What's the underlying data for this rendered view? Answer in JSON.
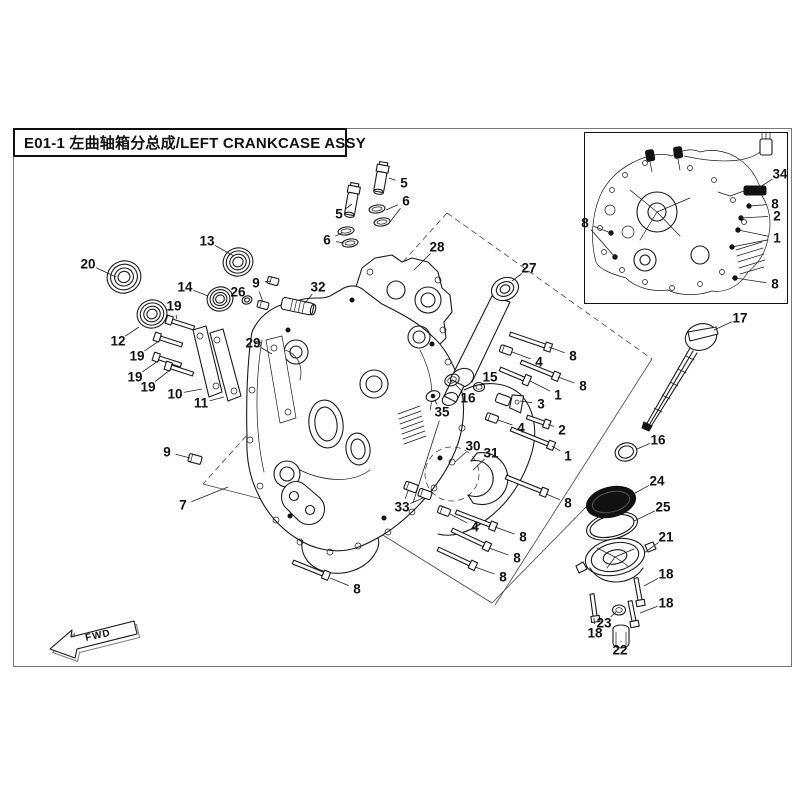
{
  "title": {
    "full": "E01-1  左曲轴箱分总成/LEFT CRANKCASE ASSY"
  },
  "fwd_label": "FWD",
  "colors": {
    "line": "#1a1a1a",
    "background": "#ffffff",
    "frame": "#777777"
  },
  "callouts": [
    {
      "n": "20",
      "x": 88,
      "y": 264,
      "t": [
        [
          116,
          277
        ]
      ]
    },
    {
      "n": "13",
      "x": 207,
      "y": 241,
      "t": [
        [
          234,
          256
        ]
      ]
    },
    {
      "n": "5",
      "x": 339,
      "y": 214,
      "t": [
        [
          352,
          204
        ]
      ]
    },
    {
      "n": "6",
      "x": 327,
      "y": 240,
      "t": [
        [
          342,
          233
        ],
        [
          344,
          243
        ]
      ]
    },
    {
      "n": "5",
      "x": 404,
      "y": 183,
      "t": [
        [
          389,
          178
        ]
      ]
    },
    {
      "n": "6",
      "x": 406,
      "y": 201,
      "t": [
        [
          386,
          210
        ],
        [
          390,
          222
        ]
      ]
    },
    {
      "n": "28",
      "x": 437,
      "y": 247,
      "t": [
        [
          414,
          270
        ]
      ]
    },
    {
      "n": "27",
      "x": 529,
      "y": 268,
      "t": [
        [
          512,
          281
        ]
      ]
    },
    {
      "n": "32",
      "x": 318,
      "y": 287,
      "t": [
        [
          305,
          303
        ]
      ]
    },
    {
      "n": "9",
      "x": 256,
      "y": 283,
      "t": [
        [
          271,
          281
        ],
        [
          263,
          302
        ]
      ]
    },
    {
      "n": "26",
      "x": 238,
      "y": 292,
      "t": [
        [
          246,
          299
        ]
      ]
    },
    {
      "n": "14",
      "x": 185,
      "y": 287,
      "t": [
        [
          208,
          296
        ]
      ]
    },
    {
      "n": "19",
      "x": 174,
      "y": 306,
      "t": [
        [
          177,
          319
        ]
      ]
    },
    {
      "n": "12",
      "x": 118,
      "y": 341,
      "t": [
        [
          139,
          327
        ]
      ]
    },
    {
      "n": "19",
      "x": 137,
      "y": 356,
      "t": [
        [
          159,
          341
        ]
      ]
    },
    {
      "n": "19",
      "x": 135,
      "y": 377,
      "t": [
        [
          158,
          361
        ]
      ]
    },
    {
      "n": "19",
      "x": 148,
      "y": 387,
      "t": [
        [
          170,
          370
        ]
      ]
    },
    {
      "n": "10",
      "x": 175,
      "y": 394,
      "t": [
        [
          202,
          389
        ]
      ]
    },
    {
      "n": "11",
      "x": 201,
      "y": 403,
      "t": [
        [
          224,
          397
        ]
      ]
    },
    {
      "n": "29",
      "x": 253,
      "y": 343,
      "t": [
        [
          272,
          354
        ]
      ]
    },
    {
      "n": "9",
      "x": 167,
      "y": 452,
      "t": [
        [
          190,
          458
        ]
      ]
    },
    {
      "n": "7",
      "x": 183,
      "y": 505,
      "t": [
        [
          228,
          487
        ]
      ]
    },
    {
      "n": "17",
      "x": 740,
      "y": 318,
      "t": [
        [
          714,
          330
        ]
      ]
    },
    {
      "n": "8",
      "x": 573,
      "y": 356,
      "t": [
        [
          549,
          347
        ]
      ]
    },
    {
      "n": "4",
      "x": 539,
      "y": 362,
      "t": [
        [
          512,
          352
        ]
      ]
    },
    {
      "n": "8",
      "x": 583,
      "y": 386,
      "t": [
        [
          558,
          377
        ]
      ]
    },
    {
      "n": "1",
      "x": 558,
      "y": 395,
      "t": [
        [
          530,
          381
        ]
      ]
    },
    {
      "n": "15",
      "x": 490,
      "y": 377,
      "t": [
        [
          481,
          386
        ]
      ]
    },
    {
      "n": "16",
      "x": 468,
      "y": 398,
      "t": [
        [
          455,
          384
        ]
      ]
    },
    {
      "n": "3",
      "x": 541,
      "y": 404,
      "t": [
        [
          520,
          401
        ]
      ]
    },
    {
      "n": "35",
      "x": 442,
      "y": 412,
      "t": [
        [
          435,
          401
        ],
        [
          413,
          503
        ]
      ]
    },
    {
      "n": "2",
      "x": 562,
      "y": 430,
      "t": [
        [
          548,
          424
        ]
      ]
    },
    {
      "n": "4",
      "x": 521,
      "y": 428,
      "t": [
        [
          498,
          420
        ]
      ]
    },
    {
      "n": "1",
      "x": 568,
      "y": 456,
      "t": [
        [
          552,
          446
        ]
      ]
    },
    {
      "n": "30",
      "x": 473,
      "y": 446,
      "t": [
        [
          455,
          462
        ]
      ]
    },
    {
      "n": "31",
      "x": 491,
      "y": 453,
      "t": [
        [
          473,
          470
        ]
      ]
    },
    {
      "n": "16",
      "x": 658,
      "y": 440,
      "t": [
        [
          637,
          449
        ]
      ]
    },
    {
      "n": "33",
      "x": 402,
      "y": 507,
      "t": [
        [
          408,
          491
        ],
        [
          423,
          498
        ]
      ]
    },
    {
      "n": "4",
      "x": 475,
      "y": 527,
      "t": [
        [
          450,
          514
        ]
      ]
    },
    {
      "n": "8",
      "x": 523,
      "y": 537,
      "t": [
        [
          495,
          527
        ]
      ]
    },
    {
      "n": "8",
      "x": 517,
      "y": 558,
      "t": [
        [
          489,
          548
        ]
      ]
    },
    {
      "n": "8",
      "x": 503,
      "y": 577,
      "t": [
        [
          475,
          567
        ]
      ]
    },
    {
      "n": "8",
      "x": 568,
      "y": 503,
      "t": [
        [
          546,
          494
        ]
      ]
    },
    {
      "n": "8",
      "x": 357,
      "y": 589,
      "t": [
        [
          330,
          578
        ]
      ]
    },
    {
      "n": "24",
      "x": 657,
      "y": 481,
      "t": [
        [
          628,
          497
        ]
      ]
    },
    {
      "n": "25",
      "x": 663,
      "y": 507,
      "t": [
        [
          634,
          521
        ]
      ]
    },
    {
      "n": "21",
      "x": 666,
      "y": 537,
      "t": [
        [
          644,
          553
        ]
      ]
    },
    {
      "n": "18",
      "x": 666,
      "y": 574,
      "t": [
        [
          644,
          586
        ]
      ]
    },
    {
      "n": "18",
      "x": 666,
      "y": 603,
      "t": [
        [
          640,
          613
        ]
      ]
    },
    {
      "n": "23",
      "x": 604,
      "y": 623,
      "t": [
        [
          616,
          612
        ]
      ]
    },
    {
      "n": "18",
      "x": 595,
      "y": 633,
      "t": [
        [
          594,
          618
        ]
      ]
    },
    {
      "n": "22",
      "x": 620,
      "y": 650,
      "t": [
        [
          621,
          642
        ]
      ]
    }
  ],
  "inset": {
    "callouts": [
      {
        "n": "34",
        "x": 780,
        "y": 174,
        "t": [
          [
            757,
            189
          ]
        ]
      },
      {
        "n": "8",
        "x": 775,
        "y": 204,
        "t": [
          [
            749,
            206
          ]
        ]
      },
      {
        "n": "2",
        "x": 777,
        "y": 216,
        "t": [
          [
            741,
            218
          ]
        ]
      },
      {
        "n": "1",
        "x": 777,
        "y": 238,
        "t": [
          [
            738,
            230
          ],
          [
            732,
            247
          ]
        ]
      },
      {
        "n": "8",
        "x": 775,
        "y": 284,
        "t": [
          [
            735,
            278
          ]
        ]
      },
      {
        "n": "8",
        "x": 585,
        "y": 223,
        "t": [
          [
            611,
            233
          ],
          [
            615,
            257
          ]
        ]
      }
    ]
  }
}
